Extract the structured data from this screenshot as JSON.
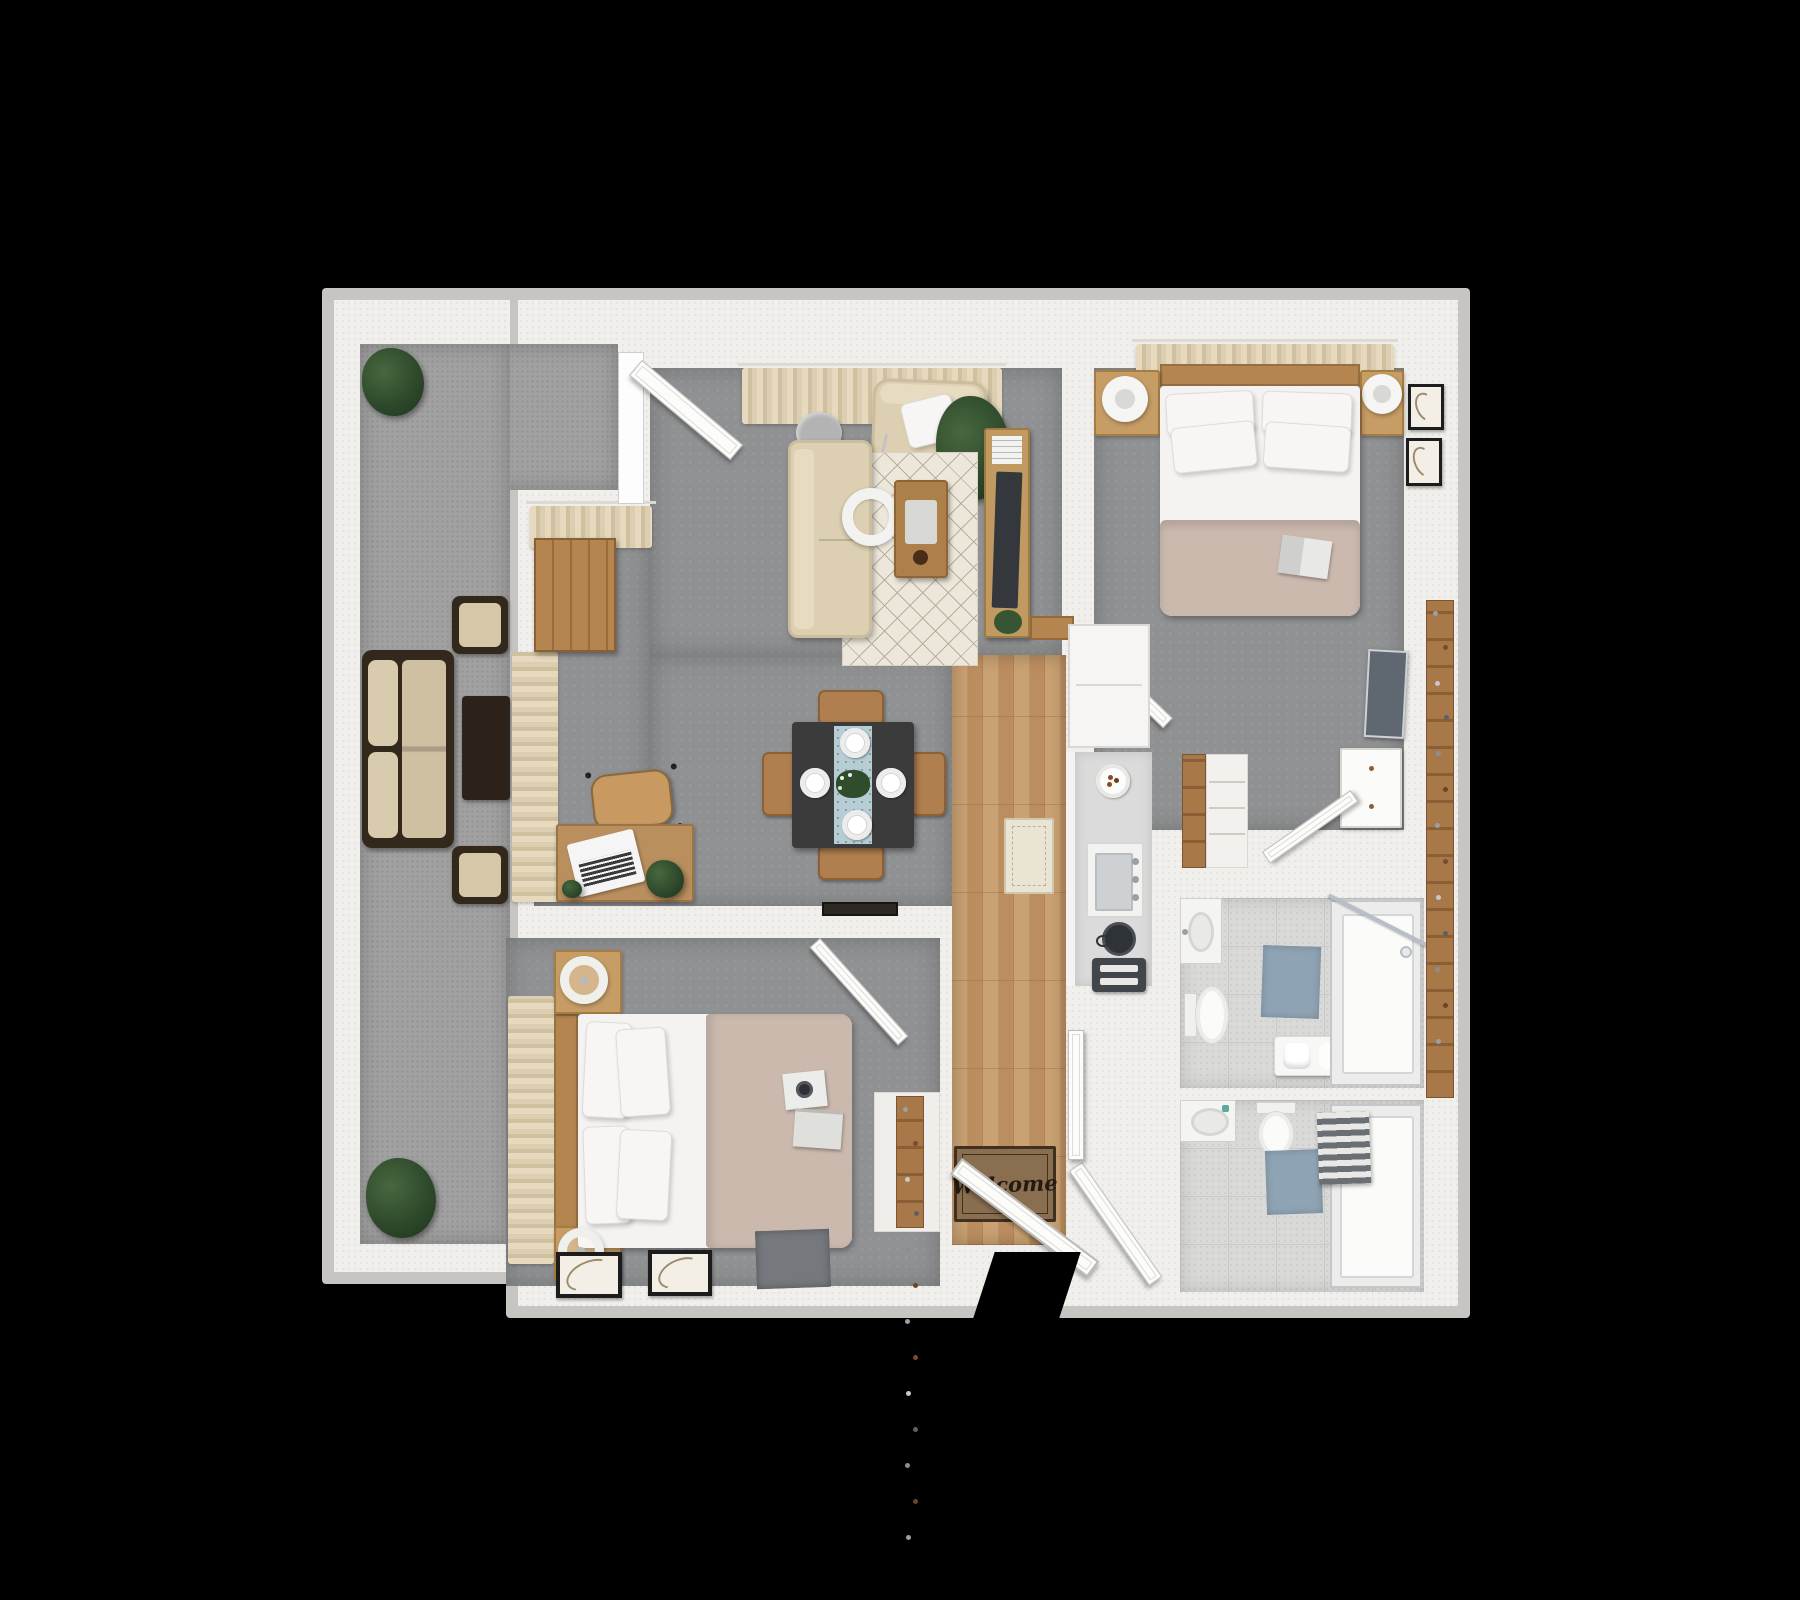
{
  "scene": {
    "type": "3d-floor-plan",
    "description": "Top-down 3D rendered floor plan of a two-bedroom, two-bathroom apartment with balcony",
    "background_color": "#000000"
  },
  "colors": {
    "wall": "#f1efeb",
    "wall_trim": "#c7c5c2",
    "interior_carpet": "#8f9193",
    "balcony_carpet": "#a1a1a1",
    "wood_floor": "#c49a6c",
    "wood_furniture": "#b5854f",
    "sofa_beige": "#ddd0b2",
    "duvet_taupe": "#cbb9ae",
    "bath_tile": "#d9d9d7",
    "bath_mat_blue": "#8ea3b4",
    "plant_green": "#2c4729",
    "welcome_mat_brown": "#8a6e50"
  },
  "entry": {
    "welcome_mat_text": "Welcome",
    "furniture": [
      "front door",
      "welcome mat",
      "shoe closet"
    ]
  },
  "rooms": [
    {
      "name": "balcony",
      "furniture": [
        "outdoor sofa",
        "two lounge chairs",
        "coffee table",
        "two potted plants"
      ]
    },
    {
      "name": "living-room",
      "furniture": [
        "sofa",
        "armchair",
        "throw pillow",
        "diamond-pattern rug",
        "coffee table with tray",
        "arc floor lamp",
        "media console",
        "tv",
        "magazines",
        "potted plant",
        "curtains",
        "sliding glass door"
      ]
    },
    {
      "name": "dining-area",
      "furniture": [
        "wood dining table",
        "four chairs",
        "four place settings",
        "blue table runner",
        "plant centerpiece"
      ]
    },
    {
      "name": "office-nook",
      "furniture": [
        "desk",
        "laptop",
        "office chair",
        "bookshelf",
        "desk plant",
        "window curtains"
      ]
    },
    {
      "name": "bedroom-1",
      "furniture": [
        "queen bed",
        "four pillows",
        "taupe duvet",
        "open book",
        "two nightstands",
        "two lamps",
        "headboard curtains",
        "two framed artworks",
        "wall tv",
        "white dresser",
        "walk-in closet"
      ]
    },
    {
      "name": "bedroom-2",
      "furniture": [
        "queen bed",
        "four pillows",
        "taupe duvet",
        "camera",
        "book",
        "two nightstands",
        "two ring lamps",
        "window curtains",
        "two framed prints on floor",
        "gray floor mat"
      ]
    },
    {
      "name": "kitchen",
      "furniture": [
        "counter",
        "sink",
        "kettle",
        "toaster",
        "breakfast plate",
        "refrigerator",
        "runner rug",
        "wood plank floor"
      ]
    },
    {
      "name": "bathroom-1",
      "furniture": [
        "vanity sink",
        "toilet",
        "blue bath mat",
        "towel bench",
        "glass shower"
      ]
    },
    {
      "name": "bathroom-2",
      "furniture": [
        "vanity sink",
        "toilet",
        "blue bath mat",
        "bathtub shower",
        "striped towels"
      ]
    },
    {
      "name": "closets",
      "furniture": [
        "linen shelves",
        "shoe shelves"
      ]
    }
  ]
}
